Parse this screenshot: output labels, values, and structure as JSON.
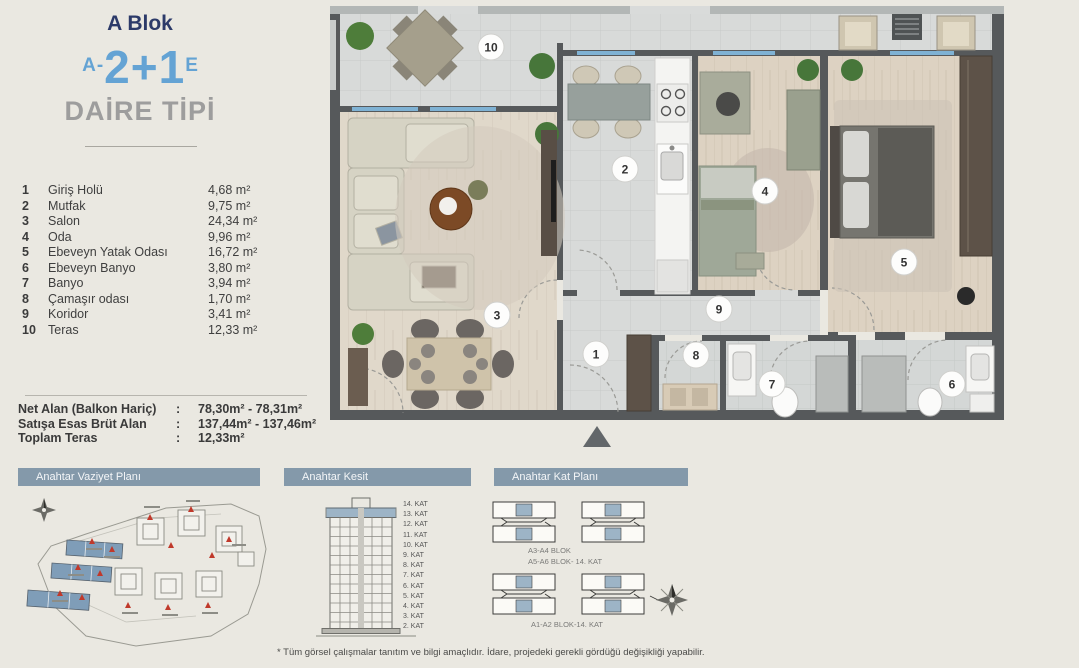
{
  "header": {
    "block_label": "A Blok",
    "unit_code": {
      "prefix": "A-",
      "main": "2+1",
      "suffix": "E"
    },
    "subtitle": "DAİRE TİPİ"
  },
  "rooms": [
    {
      "no": "1",
      "name": "Giriş Holü",
      "area": "4,68 m²"
    },
    {
      "no": "2",
      "name": "Mutfak",
      "area": "9,75 m²"
    },
    {
      "no": "3",
      "name": "Salon",
      "area": "24,34 m²"
    },
    {
      "no": "4",
      "name": "Oda",
      "area": "9,96 m²"
    },
    {
      "no": "5",
      "name": "Ebeveyn Yatak Odası",
      "area": "16,72 m²"
    },
    {
      "no": "6",
      "name": "Ebeveyn Banyo",
      "area": "3,80 m²"
    },
    {
      "no": "7",
      "name": "Banyo",
      "area": "3,94 m²"
    },
    {
      "no": "8",
      "name": "Çamaşır odası",
      "area": "1,70 m²"
    },
    {
      "no": "9",
      "name": "Koridor",
      "area": "3,41 m²"
    },
    {
      "no": "10",
      "name": "Teras",
      "area": "12,33 m²"
    }
  ],
  "summary": {
    "rows": [
      {
        "label": "Net Alan (Balkon Hariç)",
        "colon": ":",
        "value": "78,30m² - 78,31m²"
      },
      {
        "label": "Satışa Esas Brüt Alan",
        "colon": ":",
        "value": "137,44m² - 137,46m²"
      },
      {
        "label": "Toplam Teras",
        "colon": ":",
        "value": "12,33m²"
      }
    ]
  },
  "section_titles": {
    "site": "Anahtar Vaziyet Planı",
    "kesit": "Anahtar Kesit",
    "kat": "Anahtar Kat Planı"
  },
  "kesit": {
    "floors": [
      "14. KAT",
      "13. KAT",
      "12. KAT",
      "11. KAT",
      "10. KAT",
      "9. KAT",
      "8. KAT",
      "7. KAT",
      "6. KAT",
      "5. KAT",
      "4. KAT",
      "3. KAT",
      "2. KAT"
    ]
  },
  "kat_plani": {
    "label_row1a": "A3-A4 BLOK",
    "label_row1b": "A5-A6 BLOK- 14. KAT",
    "label_row2": "A1-A2 BLOK-14. KAT"
  },
  "plan_badges": [
    {
      "no": "10"
    },
    {
      "no": "2"
    },
    {
      "no": "4"
    },
    {
      "no": "5"
    },
    {
      "no": "3"
    },
    {
      "no": "9"
    },
    {
      "no": "1"
    },
    {
      "no": "8"
    },
    {
      "no": "7"
    },
    {
      "no": "6"
    }
  ],
  "footer": {
    "disclaimer": "* Tüm görsel çalışmalar tanıtım ve bilgi amaçlıdır. İdare, projedeki gerekli gördüğü değişikliği yapabilir."
  },
  "colors": {
    "accent_blue": "#64a3d4",
    "navy": "#2c3a69",
    "bar": "#8499aa",
    "wall": "#56595b",
    "window": "#7fb2d4",
    "highlight": "#9db4c6"
  }
}
